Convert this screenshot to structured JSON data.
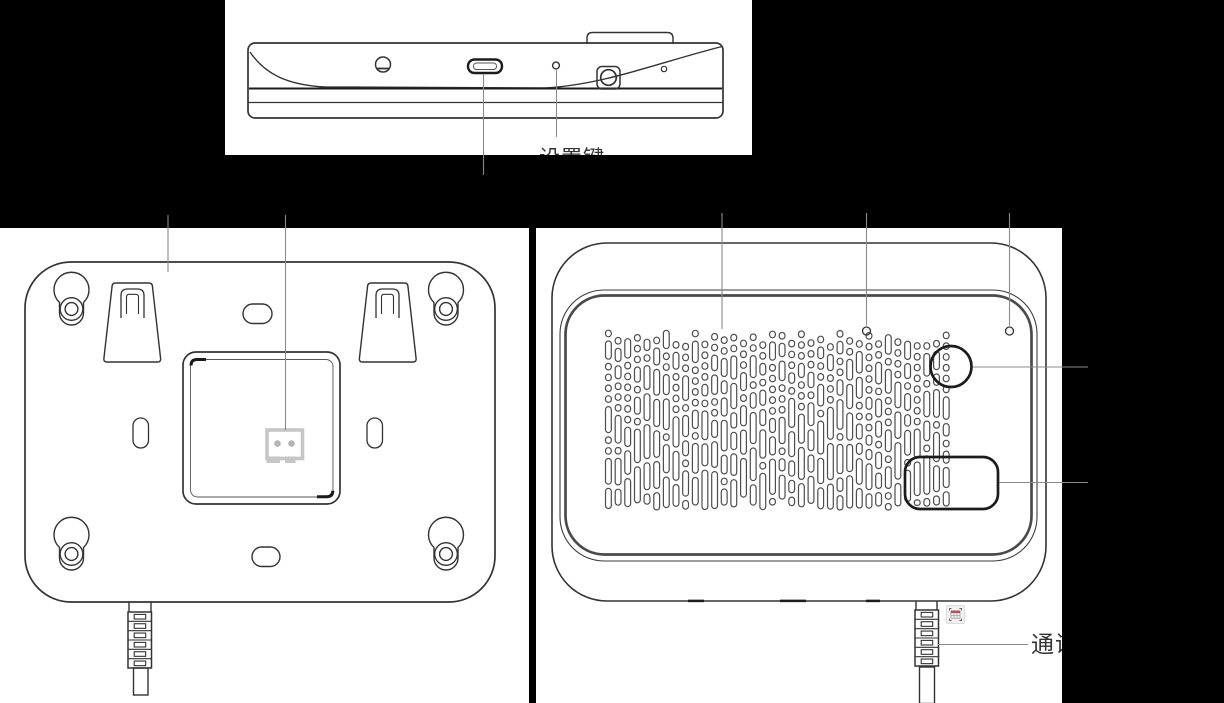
{
  "canvas": {
    "width": 1224,
    "height": 703,
    "background": "#000000",
    "panel_background": "#ffffff"
  },
  "colors": {
    "outline": "#333333",
    "outline_strong": "#1c1c1c",
    "leader_line": "#8a8a8a",
    "connector_gray": "#c6c6c6",
    "connector_dot_gray": "#b5b5b5",
    "grille_stroke": "#4d4d4d",
    "badge_red": "#c0504d",
    "label_text": "#333333"
  },
  "top_view": {
    "callout_label": "设置键",
    "features": [
      "screw-hole",
      "usb-c-port",
      "setting-key-pinhole",
      "side-button",
      "pinhole"
    ]
  },
  "back_view": {
    "features": [
      "keyhole-mounts",
      "mounting-hooks",
      "top-slot",
      "bottom-slot",
      "side-slots",
      "wall-plate-recess",
      "two-pin-connector",
      "cable"
    ]
  },
  "front_view": {
    "cable_callout_label": "通讯",
    "features": [
      "speaker-grille",
      "pinhole-left",
      "pinhole-right",
      "circular-button",
      "rectangular-window",
      "cable",
      "scan-grid-badge"
    ],
    "grille": {
      "columns": 36,
      "x_start": 69.5,
      "col_spacing": 9.65,
      "y_top": 102,
      "y_bottom": 282,
      "cell_width": 5.8,
      "gap": 4.3,
      "seed": 7
    }
  }
}
